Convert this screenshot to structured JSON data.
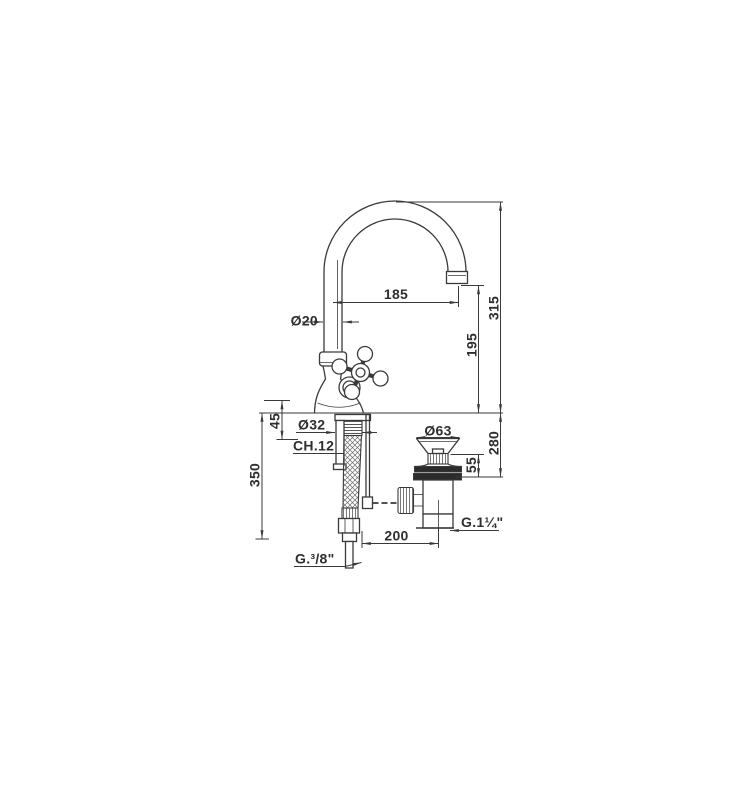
{
  "page": {
    "background": "#ffffff"
  },
  "drawing": {
    "kind": "single-hole basin mixer with swivel spout and pop-up waste — dimensional drawing",
    "line_color": "#3a3a3a",
    "labels": {
      "spout_reach": "185",
      "spout_tube_diameter": "Ø20",
      "spout_height": "315",
      "spout_clearance": "195",
      "deck_max_thickness": "45",
      "shank_diameter": "Ø32",
      "shank_wrench_size": "CH.12",
      "waste_cap_diameter": "Ø63",
      "waste_body_height": "55",
      "waste_total_height": "280",
      "hose_drop_length": "350",
      "waste_horizontal_offset": "200",
      "waste_thread": "G.1¼\"",
      "supply_thread": "G.³/8\""
    }
  }
}
